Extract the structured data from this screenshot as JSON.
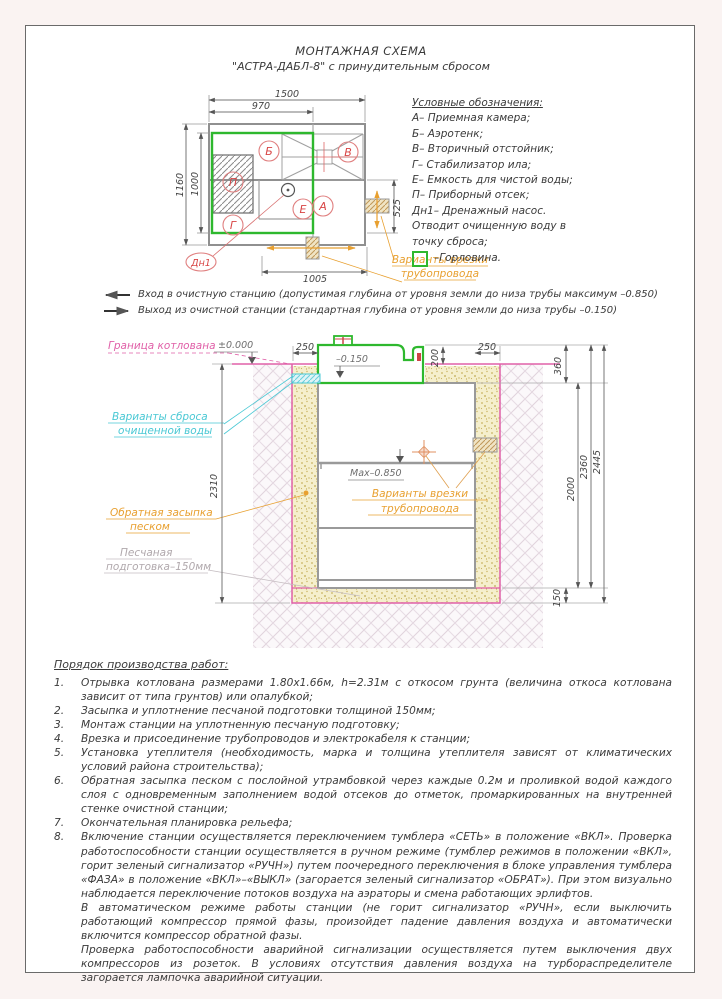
{
  "title": {
    "line1": "МОНТАЖНАЯ СХЕМА",
    "line2": "\"АСТРА-ДАБЛ-8\" с принудительным сбросом"
  },
  "legend": {
    "title": "Условные обозначения:",
    "items": [
      "А– Приемная камера;",
      "Б– Аэротенк;",
      "В– Вторичный отстойник;",
      "Г– Стабилизатор ила;",
      "Е– Емкость для чистой воды;",
      "П– Приборный отсек;",
      "Дн1– Дренажный насос.",
      "Отводит очищенную воду в",
      "точку сброса;"
    ],
    "gorlovina": "–Горловина."
  },
  "plan": {
    "dims": {
      "w_total": "1500",
      "w_inner": "970",
      "h_total": "1160",
      "h_inner": "1000",
      "h_right": "525",
      "w_bottom": "1005"
    },
    "letters": {
      "b": "Б",
      "v": "В",
      "p": "П",
      "g": "Г",
      "e": "Е",
      "a": "А",
      "dn1": "Дн1"
    },
    "pipe_note_1": "Варианты врезки",
    "pipe_note_2": "трубопровода"
  },
  "notes": {
    "inlet": "Вход в очистную станцию (допустимая глубина от уровня земли до низа трубы максимум –0.850)",
    "outlet": "Выход из очистной станции (стандартная глубина от уровня земли до низа трубы –0.150)"
  },
  "section": {
    "levels": {
      "zero": "±0.000",
      "lid": "–0.150",
      "max": "Max–0.850"
    },
    "dims": {
      "left250": "250",
      "right250": "250",
      "d200": "200",
      "d360": "360",
      "d2000": "2000",
      "d2360": "2360",
      "d2445": "2445",
      "d150": "150",
      "d2310": "2310"
    },
    "labels": {
      "pit": "Граница котлована",
      "discharge_1": "Варианты сброса",
      "discharge_2": "очищенной воды",
      "backfill_1": "Обратная засыпка",
      "backfill_2": "песком",
      "sand_1": "Песчаная",
      "sand_2": "подготовка–150мм",
      "pipe_1": "Варианты врезки",
      "pipe_2": "трубопровода"
    }
  },
  "procedure": {
    "title": "Порядок производства работ:",
    "items": [
      {
        "n": "1.",
        "t": "Отрывка котлована размерами 1.80х1.66м, h=2.31м с откосом грунта (величина откоса котлована зависит от типа грунтов) или опалубкой;"
      },
      {
        "n": "2.",
        "t": "Засыпка и уплотнение песчаной подготовки толщиной 150мм;"
      },
      {
        "n": "3.",
        "t": "Монтаж станции на уплотненную песчаную подготовку;"
      },
      {
        "n": "4.",
        "t": "Врезка и присоединение трубопроводов и электрокабеля к станции;"
      },
      {
        "n": "5.",
        "t": "Установка утеплителя (необходимость, марка и толщина утеплителя зависят от климатических условий района строительства);"
      },
      {
        "n": "6.",
        "t": "Обратная засыпка песком с послойной утрамбовкой через каждые 0.2м и проливкой водой каждого слоя с одновременным заполнением водой отсеков до отметок, промаркированных на внутренней стенке очистной станции;"
      },
      {
        "n": "7.",
        "t": "Окончательная планировка рельефа;"
      },
      {
        "n": "8.",
        "t": "Включение станции осуществляется переключением тумблера «СЕТЬ» в положение «ВКЛ». Проверка работоспособности станции осуществляется в ручном режиме (тумблер режимов в положении «ВКЛ», горит зеленый сигнализатор «РУЧН») путем поочередного переключения в блоке управления тумблера «ФАЗА»  в положение «ВКЛ»–«ВЫКЛ» (загорается зеленый сигнализатор «ОБРАТ»).  При этом визуально наблюдается переключение потоков воздуха на аэраторы и смена работающих эрлифтов."
      }
    ],
    "paragraphs": [
      "В автоматическом режиме работы станции (не горит сигнализатор «РУЧН», если выключить работающий компрессор прямой фазы, произойдет падение давления воздуха и автоматически включится компрессор обратной фазы.",
      "Проверка работоспособности аварийной сигнализации осуществляется путем выключения двух компрессоров из розеток. В условиях  отсутствия давления воздуха на турбораспределителе загорается лампочка аварийной ситуации."
    ]
  },
  "colors": {
    "green": "#2eb82e",
    "pink": "#e060a8",
    "cyan": "#49c8d4",
    "orange": "#e8a030",
    "red": "#d84545"
  }
}
